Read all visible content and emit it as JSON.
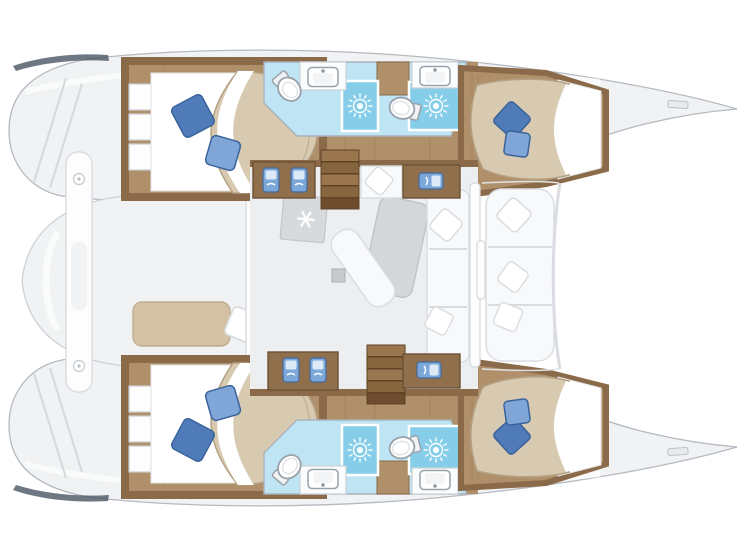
{
  "page": {
    "background": "#ffffff",
    "description": "Top-down interior floor plan of a four-cabin sailing catamaran, bow to the right"
  },
  "colors": {
    "hull_fill": "#f0f2f4",
    "hull_stroke": "#b5bac1",
    "hull_line": "#d5d9dd",
    "window_strip": "#4e5a68",
    "wood_dark": "#8a6a48",
    "wood_mid": "#b0906a",
    "wood_grain": "rgba(90,60,30,0.15)",
    "counter_wood": "#8f6f4c",
    "stair_light": "#9a764f",
    "stair_dark": "#86653f",
    "stair_gap": "#5f4226",
    "bed_tan": "#d8cab0",
    "bed_tan_edge": "#b4a184",
    "sheet_white": "#ffffff",
    "sheet_shadow": "#e2e4e6",
    "pillow_blue": "#4f7cb8",
    "pillow_blue_light": "#7fa6d6",
    "pillow_blue_dark": "#3a639c",
    "bath_floor": "#bfe4f3",
    "shower_floor": "#85cde8",
    "fixture_stroke": "#99a2aa",
    "fixture_inner": "#f2f4f6",
    "galley_blue": "#7ba8d9",
    "galley_blue_dark": "#46699a",
    "galley_blue_light": "#dce9f7",
    "saloon_floor": "#eceef0",
    "cushion_fill": "#f8f9fb",
    "cushion_stroke": "#d9dcdf",
    "table_gray": "#d4d7da",
    "table_stroke": "#c0c4c8",
    "fridge_gray": "#d7dadd",
    "fridge_stroke": "#c2c6ca",
    "bench_tan": "#d2c1a5",
    "bench_tan_stroke": "#c0ae90",
    "platform_fill": "#f0f2f4",
    "platform_stroke": "#ccd0d5",
    "wall_white": "#fdfdfe",
    "wall_stroke": "#d4d8db",
    "mast_gray": "#c6cacd"
  },
  "boat": {
    "type": "catamaran",
    "orientation": "bow-right",
    "hulls": [
      {
        "id": "port",
        "rooms": [
          "aft double cabin",
          "aft bathroom with shower",
          "forward bathroom with shower",
          "forward double cabin"
        ]
      },
      {
        "id": "starboard",
        "rooms": [
          "aft double cabin",
          "aft bathroom with shower",
          "forward bathroom with shower",
          "forward double cabin"
        ]
      }
    ],
    "bridge_deck": [
      "aft cockpit with bench and table",
      "saloon with table, chaise, sofa and fridge",
      "forward cockpit seating"
    ],
    "equipment_counts": {
      "double_berths": 4,
      "toilets": 4,
      "washbasins": 4,
      "shower_compartments": 4,
      "galley_sinks": 6,
      "companionway_stairs": 2,
      "refrigerator": 1,
      "saloon_table": 1,
      "blue_pillows": 6,
      "white_pillows": 7
    }
  },
  "icons": [
    {
      "name": "shower-drain-sun-icon",
      "count": 4
    },
    {
      "name": "snowflake-fridge-icon",
      "count": 1
    },
    {
      "name": "toilet-icon",
      "count": 4
    },
    {
      "name": "washbasin-icon",
      "count": 4
    },
    {
      "name": "galley-sink-icon",
      "count": 6
    }
  ]
}
